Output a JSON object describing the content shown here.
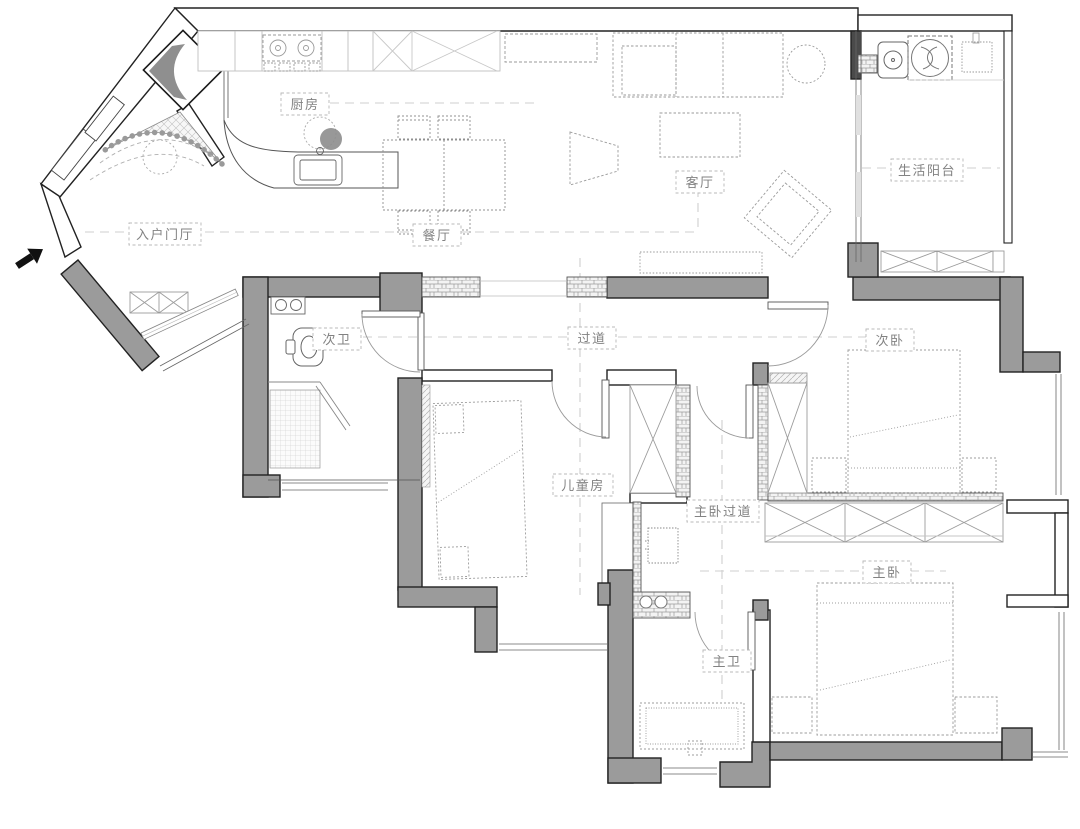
{
  "plan": {
    "type": "apartment-floor-plan",
    "colors": {
      "wall_fill": "#9b9b9b",
      "wall_outline": "#222222",
      "dark_segment": "#4a4a4a",
      "furniture_line": "#9c9c9c",
      "label_text": "#828282",
      "label_box": "#b8b8b8",
      "axis_dash": "#cfcfcf",
      "accent_chevron": "#8f8f8f"
    },
    "rooms": [
      {
        "id": "kitchen",
        "label": "厨房"
      },
      {
        "id": "dining",
        "label": "餐厅"
      },
      {
        "id": "living",
        "label": "客厅"
      },
      {
        "id": "service-balcony",
        "label": "生活阳台"
      },
      {
        "id": "entry-foyer",
        "label": "入户门厅"
      },
      {
        "id": "second-bath",
        "label": "次卫"
      },
      {
        "id": "hallway",
        "label": "过道"
      },
      {
        "id": "second-bedroom",
        "label": "次卧"
      },
      {
        "id": "kids-room",
        "label": "儿童房"
      },
      {
        "id": "master-hallway",
        "label": "主卧过道"
      },
      {
        "id": "master-bedroom",
        "label": "主卧"
      },
      {
        "id": "master-bath",
        "label": "主卫"
      }
    ],
    "icons": [
      {
        "name": "entry-direction-arrow"
      },
      {
        "name": "gas-cooktop"
      },
      {
        "name": "island-sink"
      },
      {
        "name": "bar-stool"
      },
      {
        "name": "refrigerator"
      },
      {
        "name": "dining-table"
      },
      {
        "name": "sofa"
      },
      {
        "name": "tv"
      },
      {
        "name": "coffee-table"
      },
      {
        "name": "lounge-chair"
      },
      {
        "name": "tv-console"
      },
      {
        "name": "laundry-sink"
      },
      {
        "name": "washing-machine"
      },
      {
        "name": "toilet"
      },
      {
        "name": "shower"
      },
      {
        "name": "bathroom-sink"
      },
      {
        "name": "bathtub"
      },
      {
        "name": "bed"
      },
      {
        "name": "wardrobe"
      },
      {
        "name": "nightstand"
      }
    ]
  }
}
